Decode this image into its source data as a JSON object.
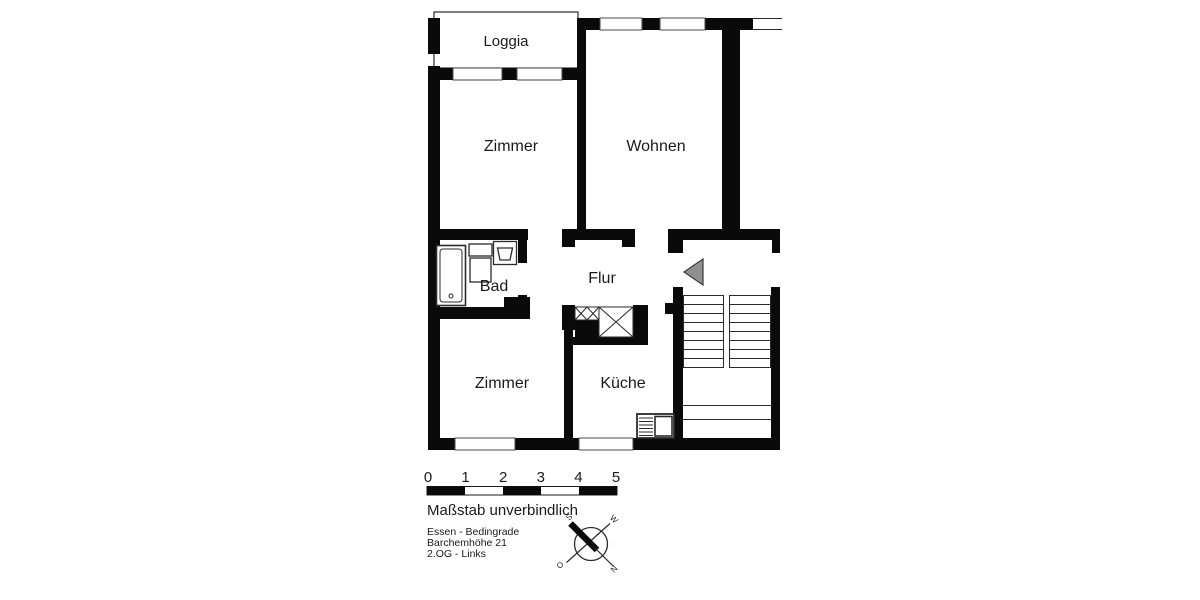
{
  "rooms": {
    "loggia": "Loggia",
    "zimmer_top": "Zimmer",
    "wohnen": "Wohnen",
    "bad": "Bad",
    "flur": "Flur",
    "zimmer_bottom": "Zimmer",
    "kueche": "Küche"
  },
  "scale_bar": {
    "ticks": [
      "0",
      "1",
      "2",
      "3",
      "4",
      "5"
    ],
    "note": "Maßstab unverbindlich"
  },
  "address": {
    "line1": "Essen - Bedingrade",
    "line2": "Barchemhöhe 21",
    "line3": "2.OG - Links"
  },
  "compass": {
    "south": "S",
    "west": "W",
    "east": "O",
    "north": "N"
  },
  "colors": {
    "wall": "#0a0a0a",
    "door_marker_fill": "#8f8f8f",
    "background": "#ffffff"
  }
}
